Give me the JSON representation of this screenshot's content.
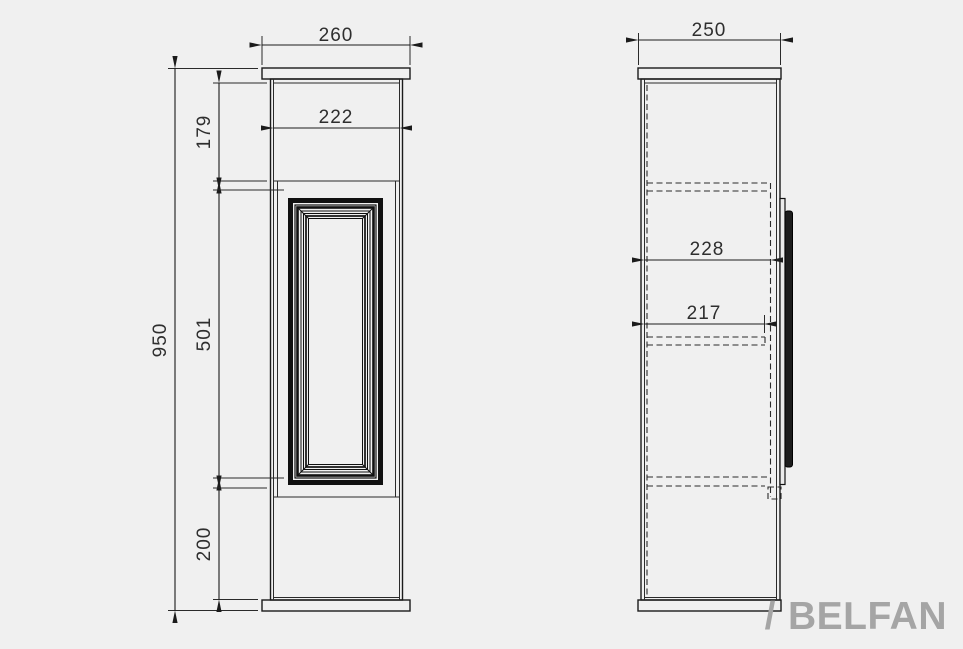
{
  "colors": {
    "background": "#f0f0f0",
    "line": "#1b1b1b",
    "dim_text": "#2e2e2e",
    "panel_black": "#111111",
    "brand_gray": "#a5a5a5"
  },
  "front_view": {
    "dims": {
      "overall_width": "260",
      "opening_width": "222",
      "top_section_height": "179",
      "panel_height": "501",
      "overall_height": "950",
      "base_height": "200"
    }
  },
  "side_view": {
    "dims": {
      "overall_depth": "250",
      "interior_depth": "228",
      "shelf_depth": "217"
    }
  },
  "brand": {
    "slash": "/",
    "name": "BELFAN"
  }
}
